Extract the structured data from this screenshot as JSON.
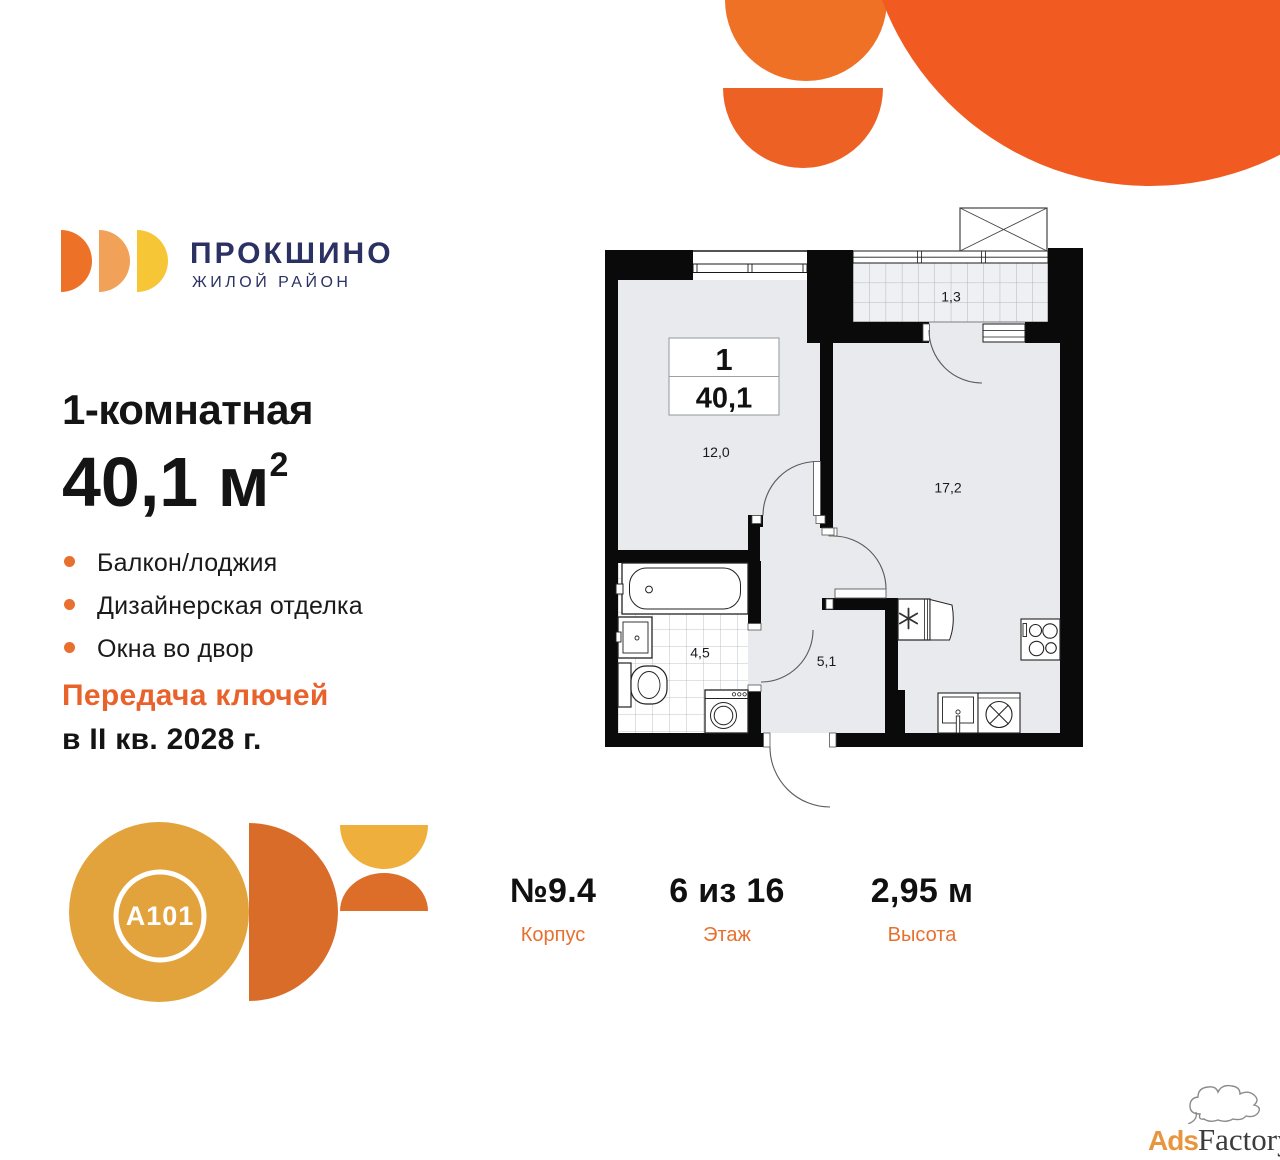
{
  "brand": {
    "name": "ПРОКШИНО",
    "tagline": "ЖИЛОЙ РАЙОН"
  },
  "listing": {
    "rooms_title": "1-комнатная",
    "area_value": "40,1 м",
    "area_sup": "2",
    "features": [
      "Балкон/лоджия",
      "Дизайнерская отделка",
      "Окна во двор"
    ],
    "handover_line1": "Передача ключей",
    "handover_line2": "в II кв. 2028 г."
  },
  "floorplan": {
    "unit_rooms": "1",
    "unit_area": "40,1",
    "labels": {
      "bedroom": "12,0",
      "living": "17,2",
      "bathroom": "4,5",
      "hallway": "5,1",
      "balcony": "1,3"
    }
  },
  "details": {
    "columns": [
      {
        "value": "№9.4",
        "label": "Корпус"
      },
      {
        "value": "6 из 16",
        "label": "Этаж"
      },
      {
        "value": "2,95 м",
        "label": "Высота"
      }
    ]
  },
  "developer": {
    "logo_text": "A101"
  },
  "watermark": {
    "part1": "Ads",
    "part2": "Factory"
  },
  "colors": {
    "accent_orange": "#E8702F",
    "decor_orange": "#F15B22",
    "brand_navy": "#2B3162",
    "a101_gold": "#E2A33C",
    "wall_black": "#0A0A0A",
    "room_fill": "#E8EAED"
  }
}
